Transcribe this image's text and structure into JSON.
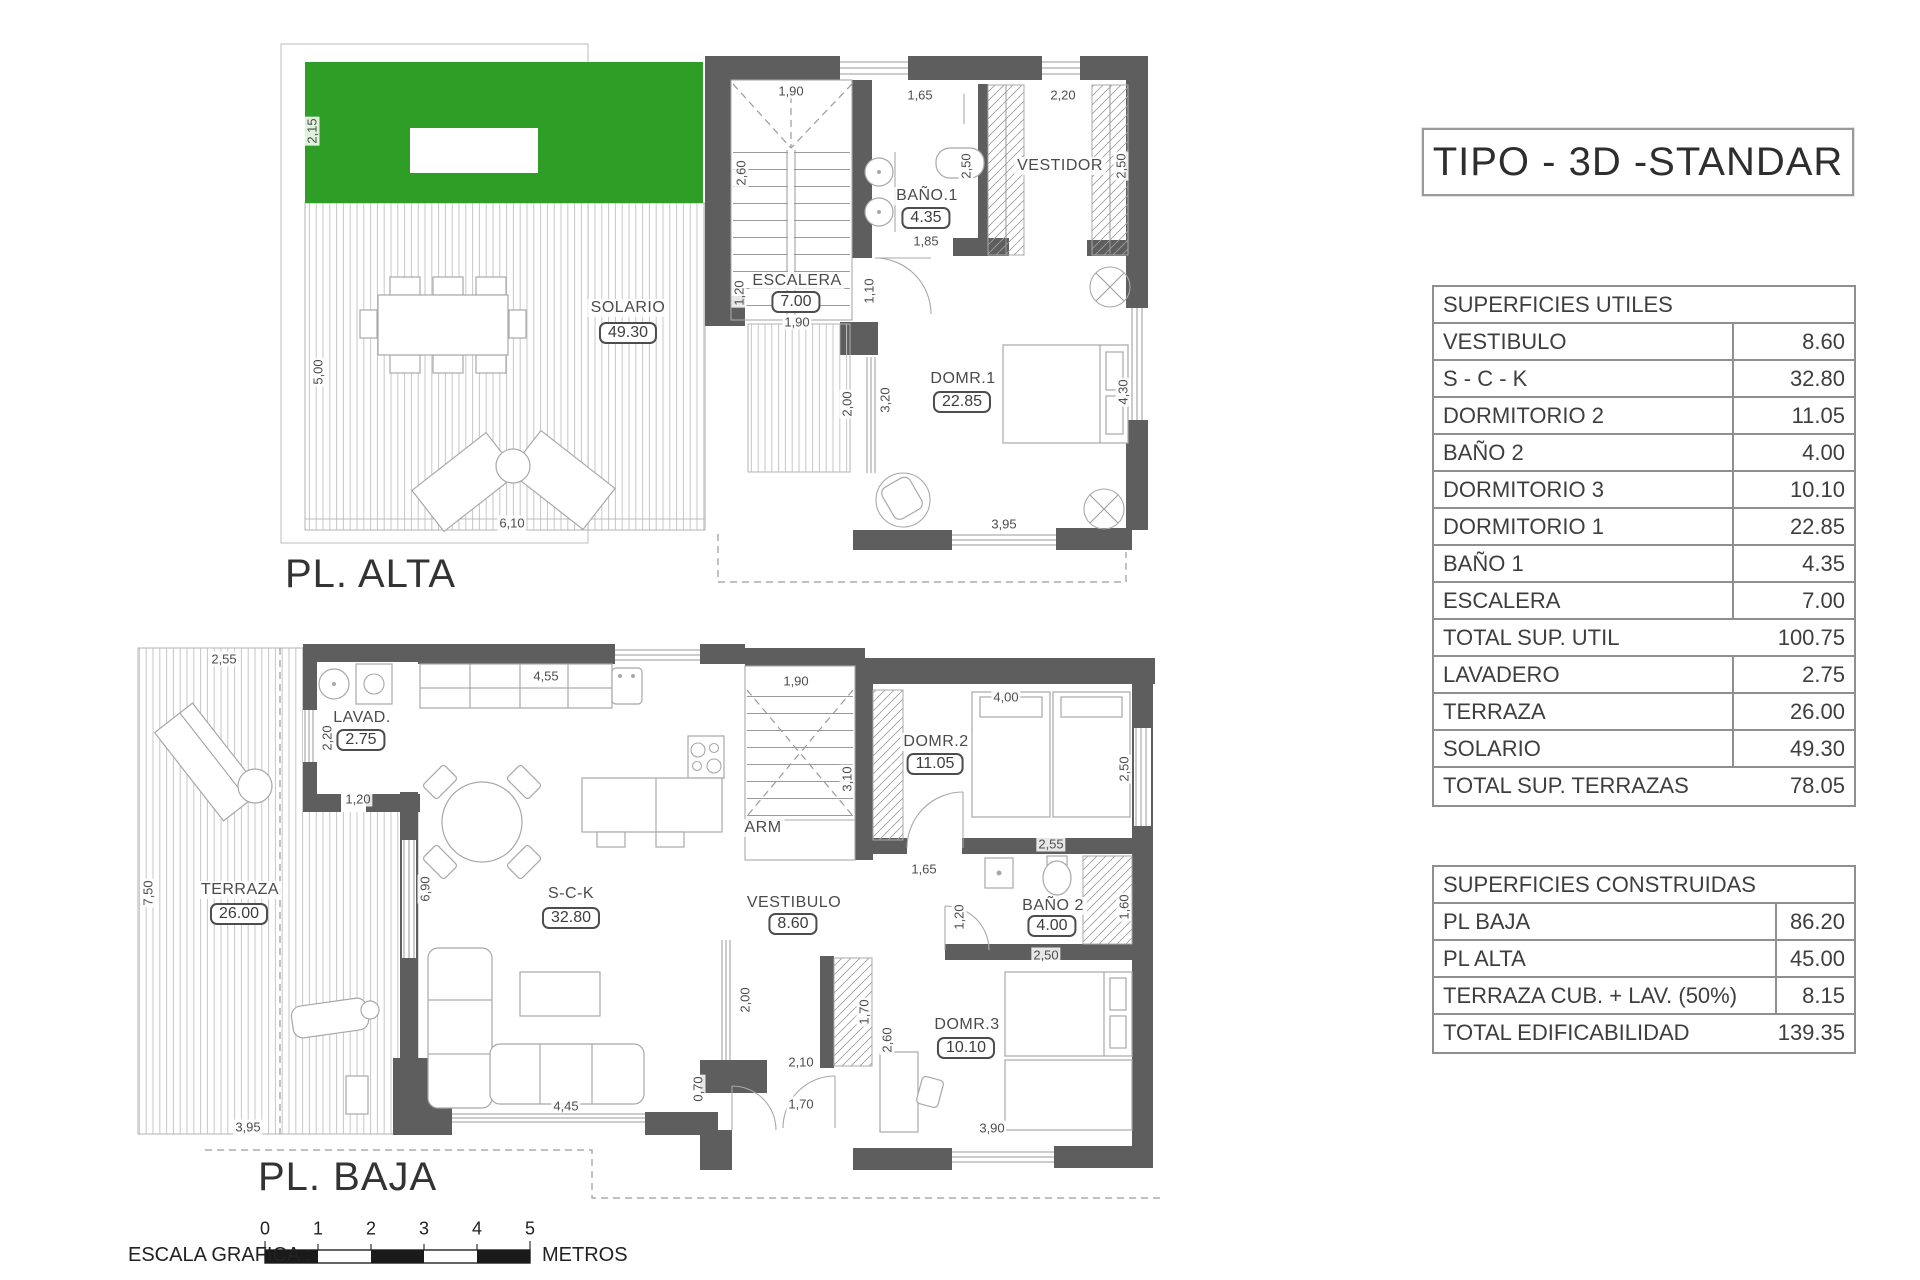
{
  "title": "TIPO - 3D -STANDAR",
  "tables": {
    "utiles": {
      "header": "SUPERFICIES UTILES",
      "rows": [
        {
          "label": "VESTIBULO",
          "value": "8.60"
        },
        {
          "label": "S - C - K",
          "value": "32.80"
        },
        {
          "label": "DORMITORIO 2",
          "value": "11.05"
        },
        {
          "label": "BAÑO 2",
          "value": "4.00"
        },
        {
          "label": "DORMITORIO 3",
          "value": "10.10"
        },
        {
          "label": "DORMITORIO 1",
          "value": "22.85"
        },
        {
          "label": "BAÑO 1",
          "value": "4.35"
        },
        {
          "label": "ESCALERA",
          "value": "7.00"
        },
        {
          "label": "TOTAL SUP. UTIL",
          "value": "100.75",
          "total": true
        },
        {
          "label": "LAVADERO",
          "value": "2.75"
        },
        {
          "label": "TERRAZA",
          "value": "26.00"
        },
        {
          "label": "SOLARIO",
          "value": "49.30"
        },
        {
          "label": "TOTAL SUP. TERRAZAS",
          "value": "78.05",
          "total": true
        }
      ]
    },
    "construidas": {
      "header": "SUPERFICIES CONSTRUIDAS",
      "rows": [
        {
          "label": "PL BAJA",
          "value": "86.20"
        },
        {
          "label": "PL ALTA",
          "value": "45.00"
        },
        {
          "label": "TERRAZA CUB. + LAV. (50%)",
          "value": "8.15"
        },
        {
          "label": "TOTAL EDIFICABILIDAD",
          "value": "139.35",
          "total": true
        }
      ]
    }
  },
  "plans": {
    "alta": {
      "name": "PL. ALTA",
      "rooms": [
        {
          "name": "SOLARIO",
          "area": "49.30",
          "x": 628,
          "y": 308,
          "ax": 628,
          "ay": 333
        },
        {
          "name": "ESCALERA",
          "area": "7.00",
          "x": 797,
          "y": 281,
          "ax": 796,
          "ay": 302
        },
        {
          "name": "BAÑO.1",
          "area": "4.35",
          "x": 927,
          "y": 196,
          "ax": 926,
          "ay": 218
        },
        {
          "name": "VESTIDOR",
          "x": 1060,
          "y": 166
        },
        {
          "name": "DOMR.1",
          "area": "22.85",
          "x": 963,
          "y": 379,
          "ax": 962,
          "ay": 402
        }
      ],
      "dims": [
        {
          "t": "2,15",
          "x": 312,
          "y": 131,
          "v": true
        },
        {
          "t": "5,00",
          "x": 318,
          "y": 372,
          "v": true
        },
        {
          "t": "6,10",
          "x": 512,
          "y": 523
        },
        {
          "t": "1,90",
          "x": 791,
          "y": 91
        },
        {
          "t": "2,60",
          "x": 741,
          "y": 173,
          "v": true
        },
        {
          "t": "1,20",
          "x": 739,
          "y": 293,
          "v": true
        },
        {
          "t": "1,10",
          "x": 869,
          "y": 291,
          "v": true
        },
        {
          "t": "1,90",
          "x": 797,
          "y": 322
        },
        {
          "t": "1,65",
          "x": 920,
          "y": 95
        },
        {
          "t": "2,50",
          "x": 966,
          "y": 166,
          "v": true
        },
        {
          "t": "1,85",
          "x": 926,
          "y": 241
        },
        {
          "t": "2,20",
          "x": 1063,
          "y": 95
        },
        {
          "t": "2,50",
          "x": 1121,
          "y": 166,
          "v": true
        },
        {
          "t": "3,20",
          "x": 885,
          "y": 400,
          "v": true
        },
        {
          "t": "2,00",
          "x": 847,
          "y": 404,
          "v": true
        },
        {
          "t": "4,30",
          "x": 1123,
          "y": 392,
          "v": true
        },
        {
          "t": "3,95",
          "x": 1004,
          "y": 524
        }
      ]
    },
    "baja": {
      "name": "PL. BAJA",
      "rooms": [
        {
          "name": "TERRAZA",
          "area": "26.00",
          "x": 240,
          "y": 890,
          "ax": 239,
          "ay": 914
        },
        {
          "name": "LAVAD.",
          "area": "2.75",
          "x": 362,
          "y": 718,
          "ax": 361,
          "ay": 740
        },
        {
          "name": "S-C-K",
          "area": "32.80",
          "x": 571,
          "y": 894,
          "ax": 571,
          "ay": 918
        },
        {
          "name": "VESTIBULO",
          "area": "8.60",
          "x": 794,
          "y": 903,
          "ax": 793,
          "ay": 924
        },
        {
          "name": "ARM",
          "x": 763,
          "y": 828
        },
        {
          "name": "DOMR.2",
          "area": "11.05",
          "x": 936,
          "y": 742,
          "ax": 935,
          "ay": 764
        },
        {
          "name": "BAÑO 2",
          "area": "4.00",
          "x": 1053,
          "y": 906,
          "ax": 1052,
          "ay": 926
        },
        {
          "name": "DOMR.3",
          "area": "10.10",
          "x": 967,
          "y": 1025,
          "ax": 966,
          "ay": 1048
        }
      ],
      "dims": [
        {
          "t": "2,55",
          "x": 224,
          "y": 659
        },
        {
          "t": "7,50",
          "x": 148,
          "y": 893,
          "v": true
        },
        {
          "t": "3,95",
          "x": 248,
          "y": 1127
        },
        {
          "t": "2,20",
          "x": 327,
          "y": 738,
          "v": true
        },
        {
          "t": "1,20",
          "x": 358,
          "y": 799
        },
        {
          "t": "4,55",
          "x": 546,
          "y": 676
        },
        {
          "t": "6,90",
          "x": 425,
          "y": 889,
          "v": true
        },
        {
          "t": "1,90",
          "x": 796,
          "y": 681
        },
        {
          "t": "3,10",
          "x": 847,
          "y": 779,
          "v": true
        },
        {
          "t": "4,00",
          "x": 1006,
          "y": 697
        },
        {
          "t": "2,50",
          "x": 1124,
          "y": 769,
          "v": true
        },
        {
          "t": "2,55",
          "x": 1051,
          "y": 844
        },
        {
          "t": "1,65",
          "x": 924,
          "y": 869
        },
        {
          "t": "1,20",
          "x": 959,
          "y": 917,
          "v": true
        },
        {
          "t": "1,60",
          "x": 1124,
          "y": 907,
          "v": true
        },
        {
          "t": "2,50",
          "x": 1046,
          "y": 955
        },
        {
          "t": "2,60",
          "x": 887,
          "y": 1040,
          "v": true
        },
        {
          "t": "1,70",
          "x": 864,
          "y": 1012,
          "v": true
        },
        {
          "t": "2,10",
          "x": 801,
          "y": 1062
        },
        {
          "t": "1,70",
          "x": 801,
          "y": 1104
        },
        {
          "t": "2,00",
          "x": 745,
          "y": 1000,
          "v": true
        },
        {
          "t": "0,70",
          "x": 698,
          "y": 1089,
          "v": true
        },
        {
          "t": "4,45",
          "x": 566,
          "y": 1106
        },
        {
          "t": "3,90",
          "x": 992,
          "y": 1128
        }
      ]
    }
  },
  "scale_bar": {
    "label": "ESCALA GRAFICA :",
    "ticks": [
      "0",
      "1",
      "2",
      "3",
      "4",
      "5"
    ],
    "units": "METROS"
  },
  "colors": {
    "grass": "#2f9e27",
    "wall": "#5e5e5e"
  }
}
